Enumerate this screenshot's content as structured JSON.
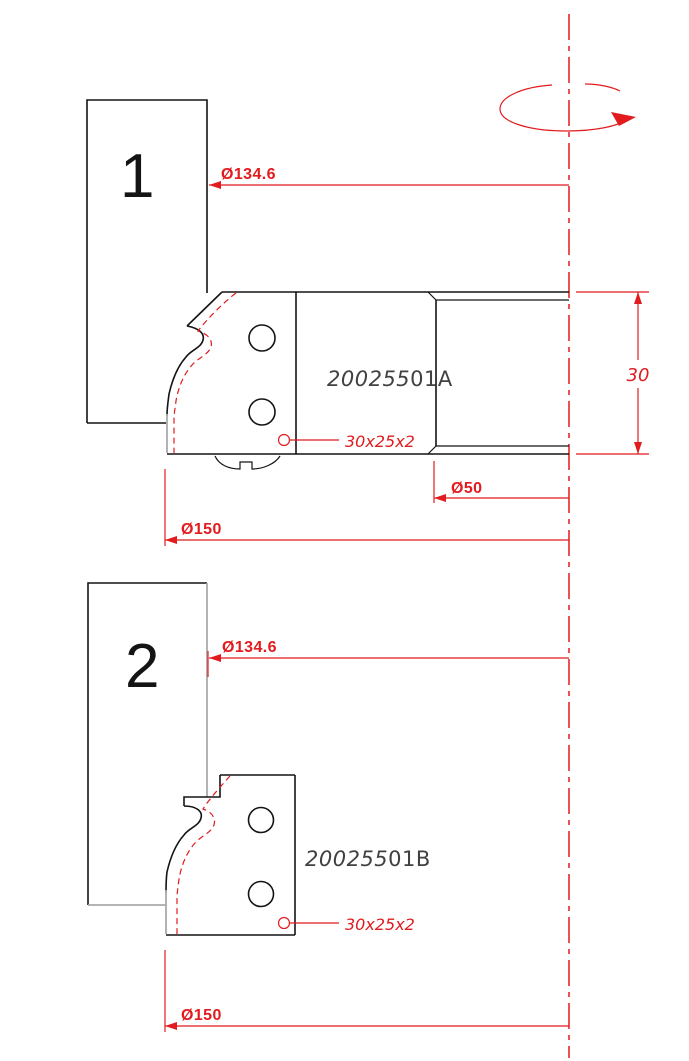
{
  "drawing": {
    "type": "technical-drawing",
    "subject": "profile cutter head with interchangeable knives",
    "colors": {
      "dimension_red": "#e11b1e",
      "outline_black": "#141414",
      "cut_face_gray": "#a9a9a9",
      "part_code_gray": "#414141",
      "background": "#ffffff"
    },
    "icons": {
      "rotation": "rotation-direction-arrow",
      "centerline": "axis-centerline-dash-dot"
    }
  },
  "view1": {
    "label": "1",
    "part_code_prefix": "200255",
    "part_code_suffix": "01A",
    "dim_cutting_diameter": "Ø134.6",
    "dim_body_width": "30",
    "dim_hub_diameter": "Ø50",
    "dim_max_diameter": "Ø150",
    "knife_note": "30x25x2"
  },
  "view2": {
    "label": "2",
    "part_code_prefix": "200255",
    "part_code_suffix": "01B",
    "dim_cutting_diameter": "Ø134.6",
    "dim_max_diameter": "Ø150",
    "knife_note": "30x25x2"
  }
}
